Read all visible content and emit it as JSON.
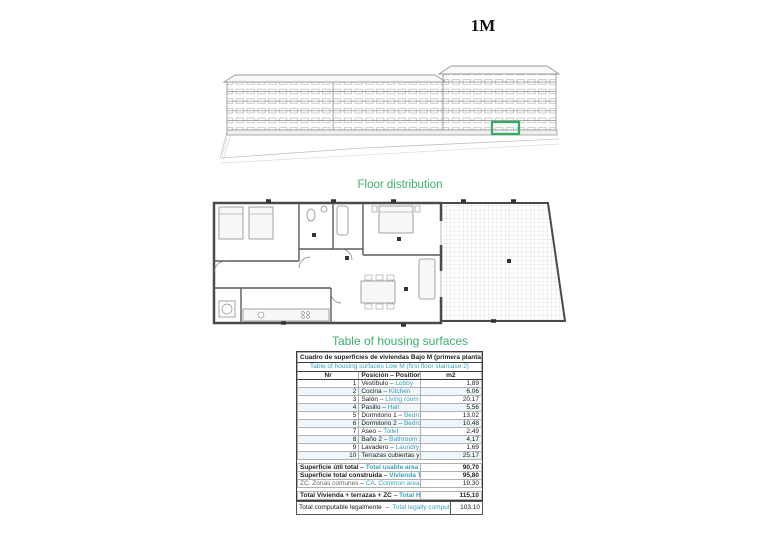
{
  "page": {
    "title": "1M"
  },
  "labels": {
    "floor_distribution": "Floor distribution",
    "table_heading": "Table of housing surfaces"
  },
  "elevation": {
    "description": "building-front-elevation-drawing",
    "highlight_color": "#2fae5f"
  },
  "table": {
    "header_es": "Cuadro de superficies de viviendas Bajo M (primera planta escalera 2)",
    "header_en": "Table of housing surfaces Low M  (first floor staircase 2)",
    "columns": [
      "Nr",
      "Posición – Position",
      "m2"
    ],
    "rows": [
      {
        "nr": "1",
        "es": "Vestíbulo",
        "en": "Lobby",
        "m2": "1,89"
      },
      {
        "nr": "2",
        "es": "Cocina",
        "en": "Kitchen",
        "m2": "6,06"
      },
      {
        "nr": "3",
        "es": "Salón",
        "en": "Living room",
        "m2": "20,17"
      },
      {
        "nr": "4",
        "es": "Pasillo",
        "en": "Hall",
        "m2": "5,56"
      },
      {
        "nr": "5",
        "es": "Dormitorio 1",
        "en": "Bedroom 1",
        "m2": "13,02"
      },
      {
        "nr": "6",
        "es": "Dormitorio 2",
        "en": "Bedroom 2",
        "m2": "10,48"
      },
      {
        "nr": "7",
        "es": "Aseo",
        "en": "Toilet",
        "m2": "2,49"
      },
      {
        "nr": "8",
        "es": "Baño 2",
        "en": "Bathroom 2",
        "m2": "4,17"
      },
      {
        "nr": "9",
        "es": "Lavadero",
        "en": "Laundry",
        "m2": "1,69"
      },
      {
        "nr": "10",
        "es": "Terrazas cubiertas y descubiertas",
        "en": "Covered and uncovered terraces",
        "m2": "25,17"
      }
    ],
    "totals": [
      {
        "es": "Superficie útil total",
        "en": "Total usable area",
        "m2": "90,70",
        "bold": true,
        "gap_before": true
      },
      {
        "es": "Superficie total construida",
        "en": "Vivienda Total built area - Housing",
        "m2": "95,80",
        "bold": true,
        "gap_before": false
      },
      {
        "es": "ZC. Zonas comunes",
        "en": "CA. Common areas",
        "m2": "19,30",
        "bold": false,
        "gap_before": false
      },
      {
        "es": "Total Vivienda + terrazas + ZC",
        "en": "Total Housing + terraces + CA",
        "m2": "115,10",
        "bold": true,
        "gap_before": true
      }
    ],
    "footer": {
      "es": "Total computable legalmente",
      "en": "Total legally computable",
      "m2": "103,10"
    }
  },
  "colors": {
    "accent_green": "#3cb06e",
    "table_teal": "#3a9fc0",
    "highlight_green": "#2fae5f"
  }
}
